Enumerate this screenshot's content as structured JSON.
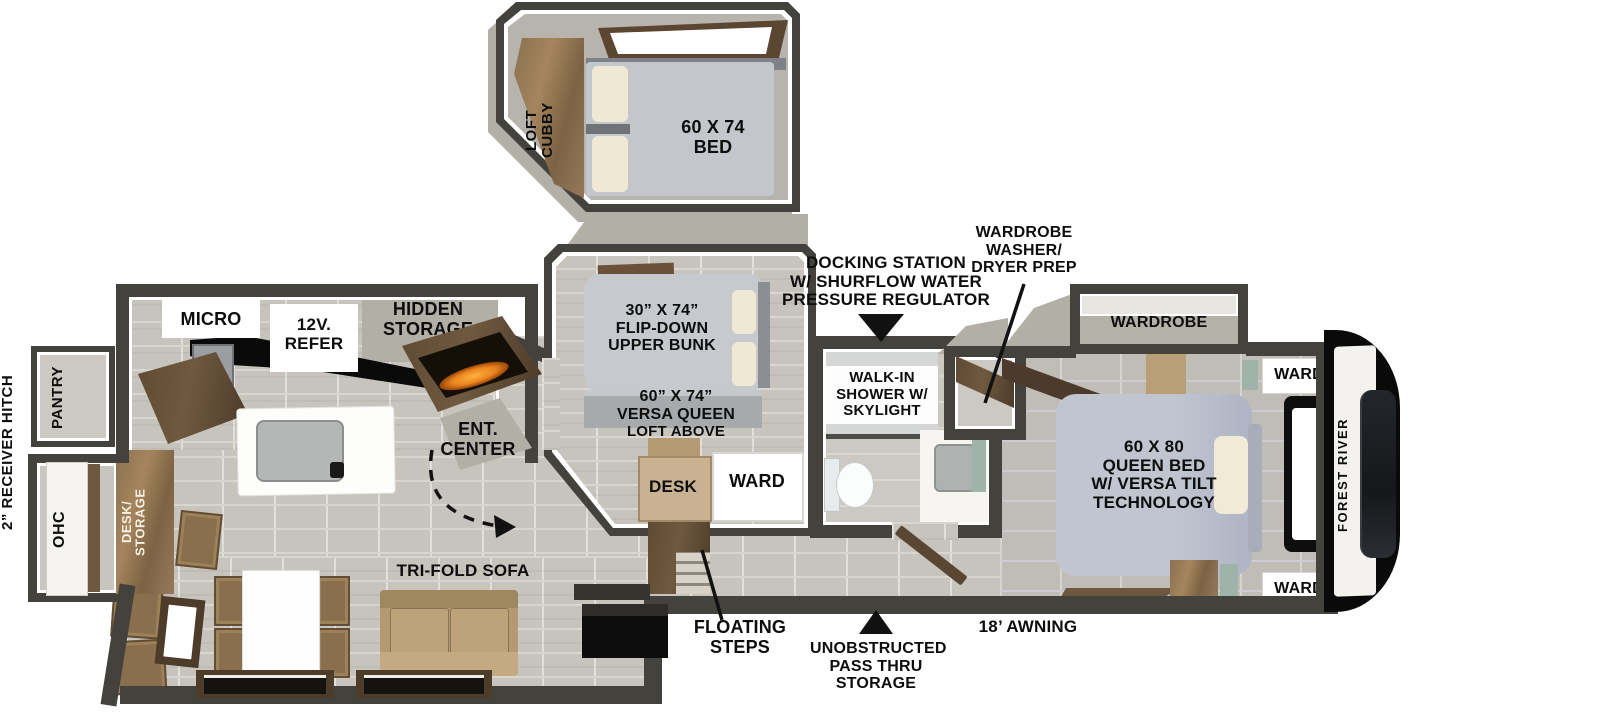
{
  "colors": {
    "wall": "#44423c",
    "fire_accent": "#e8821e",
    "teal_accent": "#9eb4ab",
    "cap_black": "#0a0a0a"
  },
  "exterior": {
    "hitch": "2” RECEIVER HITCH",
    "awning": "18’ AWNING",
    "brand": "FOREST RIVER",
    "pass_thru": "UNOBSTRUCTED\nPASS THRU\nSTORAGE",
    "floating_steps": "FLOATING\nSTEPS",
    "docking": "DOCKING STATION\nW/ SHURFLOW WATER\nPRESSURE REGULATOR"
  },
  "loft": {
    "cubby": "LOFT\nCUBBY",
    "bed": "60 X 74\nBED"
  },
  "kitchen": {
    "micro": "MICRO",
    "refer": "12V.\nREFER",
    "hidden_storage": "HIDDEN\nSTORAGE",
    "pantry": "PANTRY",
    "ohc": "OHC",
    "desk_storage": "DESK/\nSTORAGE",
    "ent_center": "ENT.\nCENTER"
  },
  "living": {
    "sofa": "TRI-FOLD SOFA"
  },
  "bunk_room": {
    "upper_bunk": "30” X 74”\nFLIP-DOWN\nUPPER BUNK",
    "versa_queen": "60” X 74”\nVERSA QUEEN",
    "loft_above": "LOFT ABOVE",
    "desk": "DESK",
    "ward": "WARD"
  },
  "bath": {
    "shower": "WALK-IN\nSHOWER W/\nSKYLIGHT",
    "wd_prep": "WARDROBE\nWASHER/\nDRYER PREP"
  },
  "bedroom": {
    "wardrobe": "WARDROBE",
    "queen_bed": "60 X 80\nQUEEN BED\nW/ VERSA TILT\nTECHNOLOGY",
    "ward_top": "WARD",
    "ward_bottom": "WARD"
  }
}
